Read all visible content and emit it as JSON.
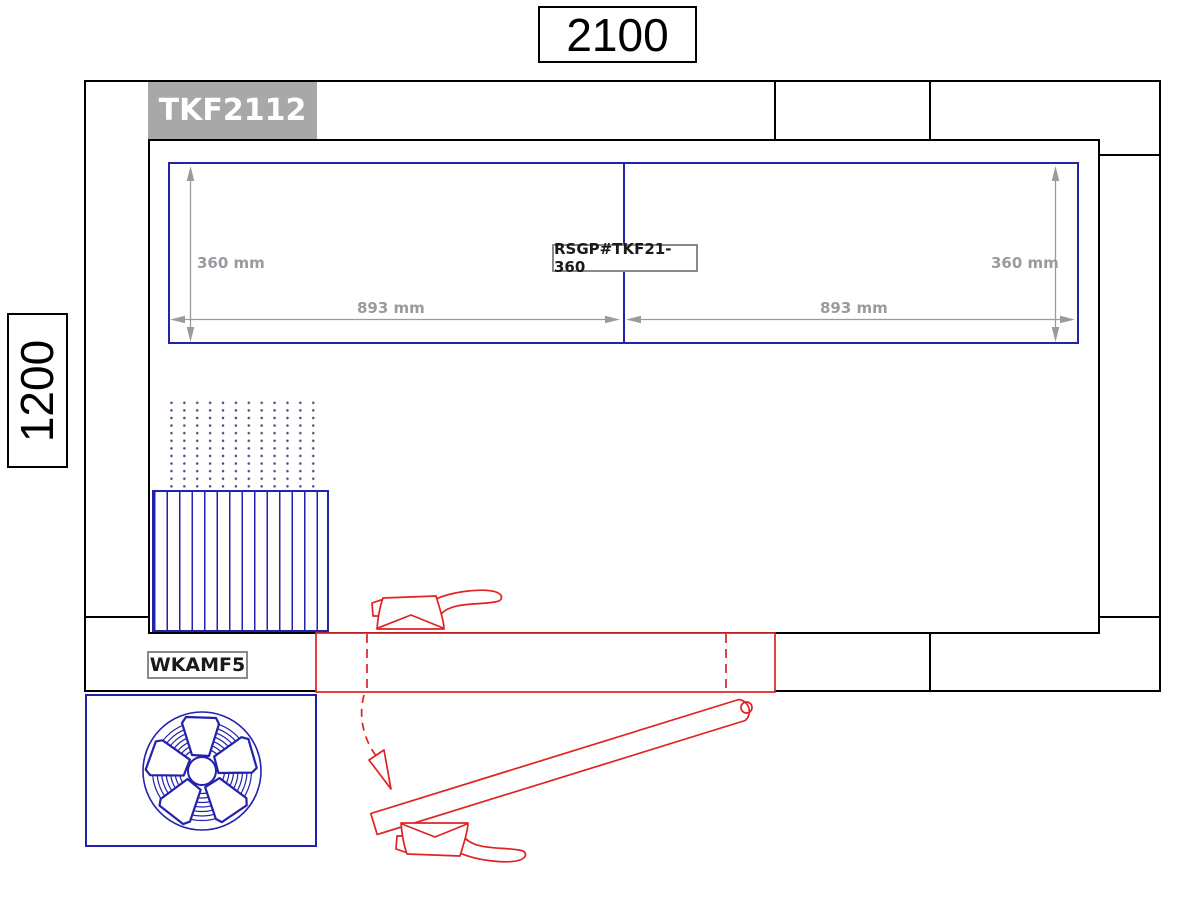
{
  "drawing": {
    "overall_width_label": "2100",
    "overall_height_label": "1200",
    "model_label": "TKF2112",
    "panel_code": "RSGP#TKF21-360",
    "fan_code": "WKAMF5",
    "dim_height_left": "360 mm",
    "dim_height_right": "360 mm",
    "dim_width_left": "893 mm",
    "dim_width_right": "893 mm"
  },
  "colors": {
    "outline_black": "#000000",
    "component_blue": "#2222ac",
    "component_red": "#e02222",
    "dimension_gray": "#9a9aa0",
    "model_box_bg": "#a8a8a8",
    "model_box_text": "#ffffff",
    "label_border_gray": "#8a8a8a"
  }
}
